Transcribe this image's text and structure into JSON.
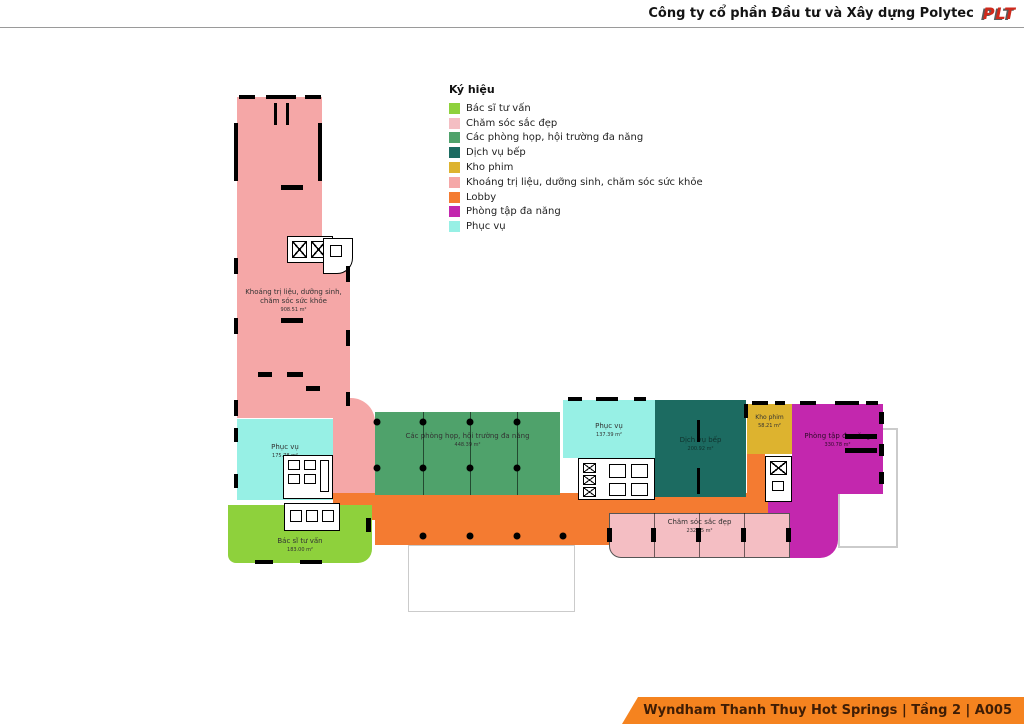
{
  "header": {
    "title": "Công ty cổ phần Đầu tư và Xây dựng Polytec",
    "logo": "PLT"
  },
  "legend": {
    "title": "Ký hiệu",
    "items": [
      {
        "label": "Bác sĩ tư vấn",
        "color": "#8ED13C"
      },
      {
        "label": "Chăm sóc sắc đẹp",
        "color": "#F4BEC3"
      },
      {
        "label": "Các phòng họp, hội trường đa năng",
        "color": "#4FA26B"
      },
      {
        "label": "Dịch vụ bếp",
        "color": "#1C6B61"
      },
      {
        "label": "Kho phim",
        "color": "#DDB32F"
      },
      {
        "label": "Khoáng trị liệu, dưỡng sinh, chăm sóc sức khỏe",
        "color": "#F5A7A7"
      },
      {
        "label": "Lobby",
        "color": "#F47B31"
      },
      {
        "label": "Phòng tập đa năng",
        "color": "#C327AE"
      },
      {
        "label": "Phục vụ",
        "color": "#97F0E5"
      }
    ]
  },
  "plan": {
    "rooms": {
      "khoang": {
        "label": "Khoáng trị liệu, dưỡng sinh, chăm sóc sức khỏe",
        "area": "908.51 m²"
      },
      "phuc_vu_trai": {
        "label": "Phục vụ",
        "area": "175.78 m²"
      },
      "bac_si": {
        "label": "Bác sĩ tư vấn",
        "area": "183.00 m²"
      },
      "phong_hop": {
        "label": "Các phòng họp, hội trường đa năng",
        "area": "448.39 m²"
      },
      "phuc_vu_giua": {
        "label": "Phục vụ",
        "area": "137.39 m²"
      },
      "dich_vu_bep": {
        "label": "Dịch vụ bếp",
        "area": "200.92 m²"
      },
      "kho_phim": {
        "label": "Kho phim",
        "area": "58.21 m²"
      },
      "phong_tap": {
        "label": "Phòng tập đa năng",
        "area": "330.78 m²"
      },
      "cham_soc": {
        "label": "Chăm sóc sắc đẹp",
        "area": "232.55 m²"
      }
    }
  },
  "footer": {
    "text": "Wyndham Thanh Thuy Hot Springs | Tầng 2 | A005"
  }
}
